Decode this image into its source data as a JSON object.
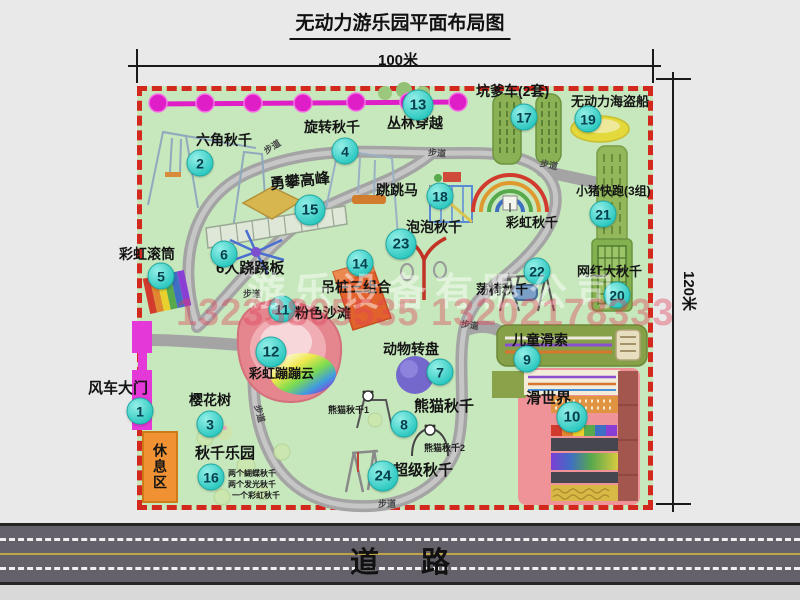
{
  "title": "无动力游乐园平面布局图",
  "dim_width": "100米",
  "dim_height": "120米",
  "road": "道路",
  "path_label": "步道",
  "rest_area": "休息区",
  "rainbow_swing": "彩虹秋千",
  "watermark": {
    "company": "游乐设备有限公司",
    "phone": "13233805535 13202178333"
  },
  "sub": {
    "panda1": "熊猫秋千1",
    "panda2": "熊猫秋千2",
    "swing1": "两个蝴蝶秋千",
    "swing2": "两个发光秋千",
    "swing3": "一个彩虹秋千"
  },
  "attractions": [
    {
      "num": "1",
      "name": "风车大门"
    },
    {
      "num": "2",
      "name": "六角秋千"
    },
    {
      "num": "3",
      "name": "樱花树"
    },
    {
      "num": "4",
      "name": "旋转秋千"
    },
    {
      "num": "5",
      "name": "彩虹滚筒"
    },
    {
      "num": "6",
      "name": "6人跷跷板"
    },
    {
      "num": "7",
      "name": "动物转盘"
    },
    {
      "num": "8",
      "name": "熊猫秋千"
    },
    {
      "num": "9",
      "name": "儿童滑索"
    },
    {
      "num": "10",
      "name": "滑世界"
    },
    {
      "num": "11",
      "name": "粉色沙滩"
    },
    {
      "num": "12",
      "name": "彩虹蹦蹦云"
    },
    {
      "num": "13",
      "name": "丛林穿越"
    },
    {
      "num": "14",
      "name": "吊桩三组合"
    },
    {
      "num": "15",
      "name": "勇攀高峰"
    },
    {
      "num": "16",
      "name": "秋千乐园"
    },
    {
      "num": "17",
      "name": "坑爹车(2套)"
    },
    {
      "num": "18",
      "name": "跳跳马"
    },
    {
      "num": "19",
      "name": "无动力海盗船"
    },
    {
      "num": "20",
      "name": "网红大秋千"
    },
    {
      "num": "21",
      "name": "小猪快跑(3组)"
    },
    {
      "num": "22",
      "name": "荡椅秋千"
    },
    {
      "num": "23",
      "name": "泡泡秋千"
    },
    {
      "num": "24",
      "name": "超级秋千"
    }
  ],
  "colors": {
    "map_bg": "#c7e8bd",
    "border_red": "#d2281e",
    "badge_teal": "#3ed3cb",
    "path_gray": "#a6a6a6",
    "gate_magenta": "#e438d8",
    "road_gray": "#64616a",
    "rest_orange": "#f09233"
  }
}
